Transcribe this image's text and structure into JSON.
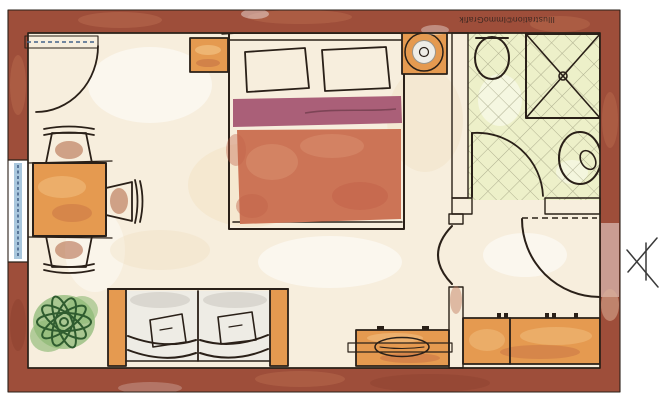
{
  "title": "apartment-floor-plan",
  "credit": "Illustration©ImmoGrafik",
  "colors": {
    "wall": "#9e4e3a",
    "wall_light": "#bb6f52",
    "wall_dark": "#8b4230",
    "outline": "#2a2018",
    "floor": "#f7eedd",
    "floor_warm": "#f0dcb8",
    "bath_floor": "#edf0c9",
    "tile_line": "#a3a383",
    "wood": "#e59a50",
    "wood_light": "#f2c080",
    "wood_dark": "#c06a42",
    "duvet": "#cc7456",
    "duvet_light": "#d98f70",
    "duvet_dark": "#c2634a",
    "pillow": "#a2586e",
    "blanket": "#aa5f78",
    "blanket_line": "#7d4456",
    "glass": "#a9c7dd",
    "glass_line": "#44628a",
    "cushion": "#eeece5",
    "cushion_shade": "#d5d2cb",
    "sofa_pillow": "#ecb45e",
    "plant_fill": "#8fba77",
    "plant_line": "#2f5c2f",
    "lamp_outer": "#d9d5cd",
    "lamp_inner": "#efede7",
    "lamp_core": "#cfcabf",
    "paper": "#ffffff",
    "mark": "#3a3a3a"
  },
  "rooms": [
    {
      "name": "living-bedroom",
      "furniture": [
        "double-bed",
        "bed-pillow-left",
        "bed-pillow-right",
        "blanket-fold",
        "duvet",
        "nightstand-left",
        "nightstand-right",
        "table-lamp",
        "dining-table",
        "chair-top",
        "chair-right",
        "chair-bottom",
        "sofa",
        "sofa-pillow-left",
        "sofa-pillow-right",
        "potted-plant",
        "sideboard"
      ]
    },
    {
      "name": "bathroom",
      "floor": "diagonal-tiles",
      "furniture": [
        "washbasin",
        "shower",
        "toilet"
      ]
    },
    {
      "name": "hallway",
      "furniture": [
        "wardrobe"
      ]
    }
  ],
  "openings": {
    "balcony_door": "top-left glazed door with swing arc",
    "window_left": "window in left wall",
    "bathroom_door": "door swinging into bathroom",
    "room_door": "arched opening between room and hallway",
    "entrance_door": "entrance in right wall with swing arc"
  },
  "entrance_marker": "arrow-icon outside right wall"
}
